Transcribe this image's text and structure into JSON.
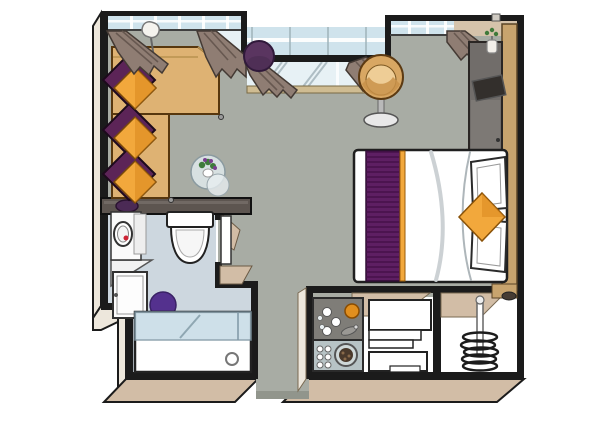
{
  "scene": {
    "type": "residence-floor-plan",
    "areas": [
      "living-area",
      "bedroom",
      "bathroom",
      "kitchenette",
      "closet",
      "entry-corridor"
    ],
    "furniture": [
      "l-shaped-sofa",
      "accent-pillows",
      "floor-lamp",
      "glass-side-table",
      "flower-bouquet",
      "window-curtains",
      "panorama-windows",
      "french-balcony-window",
      "round-pouf",
      "tub-chair",
      "tv-console",
      "wall-tv",
      "wardrobe-panel",
      "double-bed",
      "bed-throw",
      "bed-pillows",
      "accent-cushion",
      "nightstand",
      "vanity-mirror",
      "washbasin-cabinet",
      "toilet",
      "bath-rug",
      "bathtub",
      "shower-glass-screen",
      "minibar-counter",
      "towel-shelves",
      "closet-hanger-rail"
    ]
  },
  "colors": {
    "background": "#ffffff",
    "floor": "#a8aca4",
    "bathroomFloor": "#cdd7df",
    "wall": "#1b1b1b",
    "wallFaceLight": "#ede7dc",
    "wallFaceTan": "#d2bda6",
    "wallTopDark": "#5d5550",
    "glass": "#cfe3ec",
    "glassPale": "#e7f1f5",
    "sill": "#cfbc92",
    "curtain": "#8f7d73",
    "sofa": "#deb273",
    "sofaBorder": "#57370e",
    "pillowPurple": "#5c2457",
    "pillowOrange": "#f2a83c",
    "pillowOrangeShade": "#d8861c",
    "pouf": "#5a3560",
    "chairBody": "#d8a763",
    "chairSeat": "#eecd96",
    "bedWhite": "#ffffff",
    "bedRunner": "#5e1f63",
    "runnerStripe": "#46104a",
    "accentOrange": "#f2a83c",
    "headboardWood": "#c8a46e",
    "deskGray": "#716d6a",
    "tvScreen": "#332f2c",
    "counterTop": "#7f7d78",
    "counterSteel": "#b7c3c5",
    "rugPurple": "#54318e",
    "towelWhite": "#ffffff",
    "coilDark": "#1c1c1c",
    "plantGreen": "#3f7a3b",
    "mirrorRed": "#cc2233"
  }
}
